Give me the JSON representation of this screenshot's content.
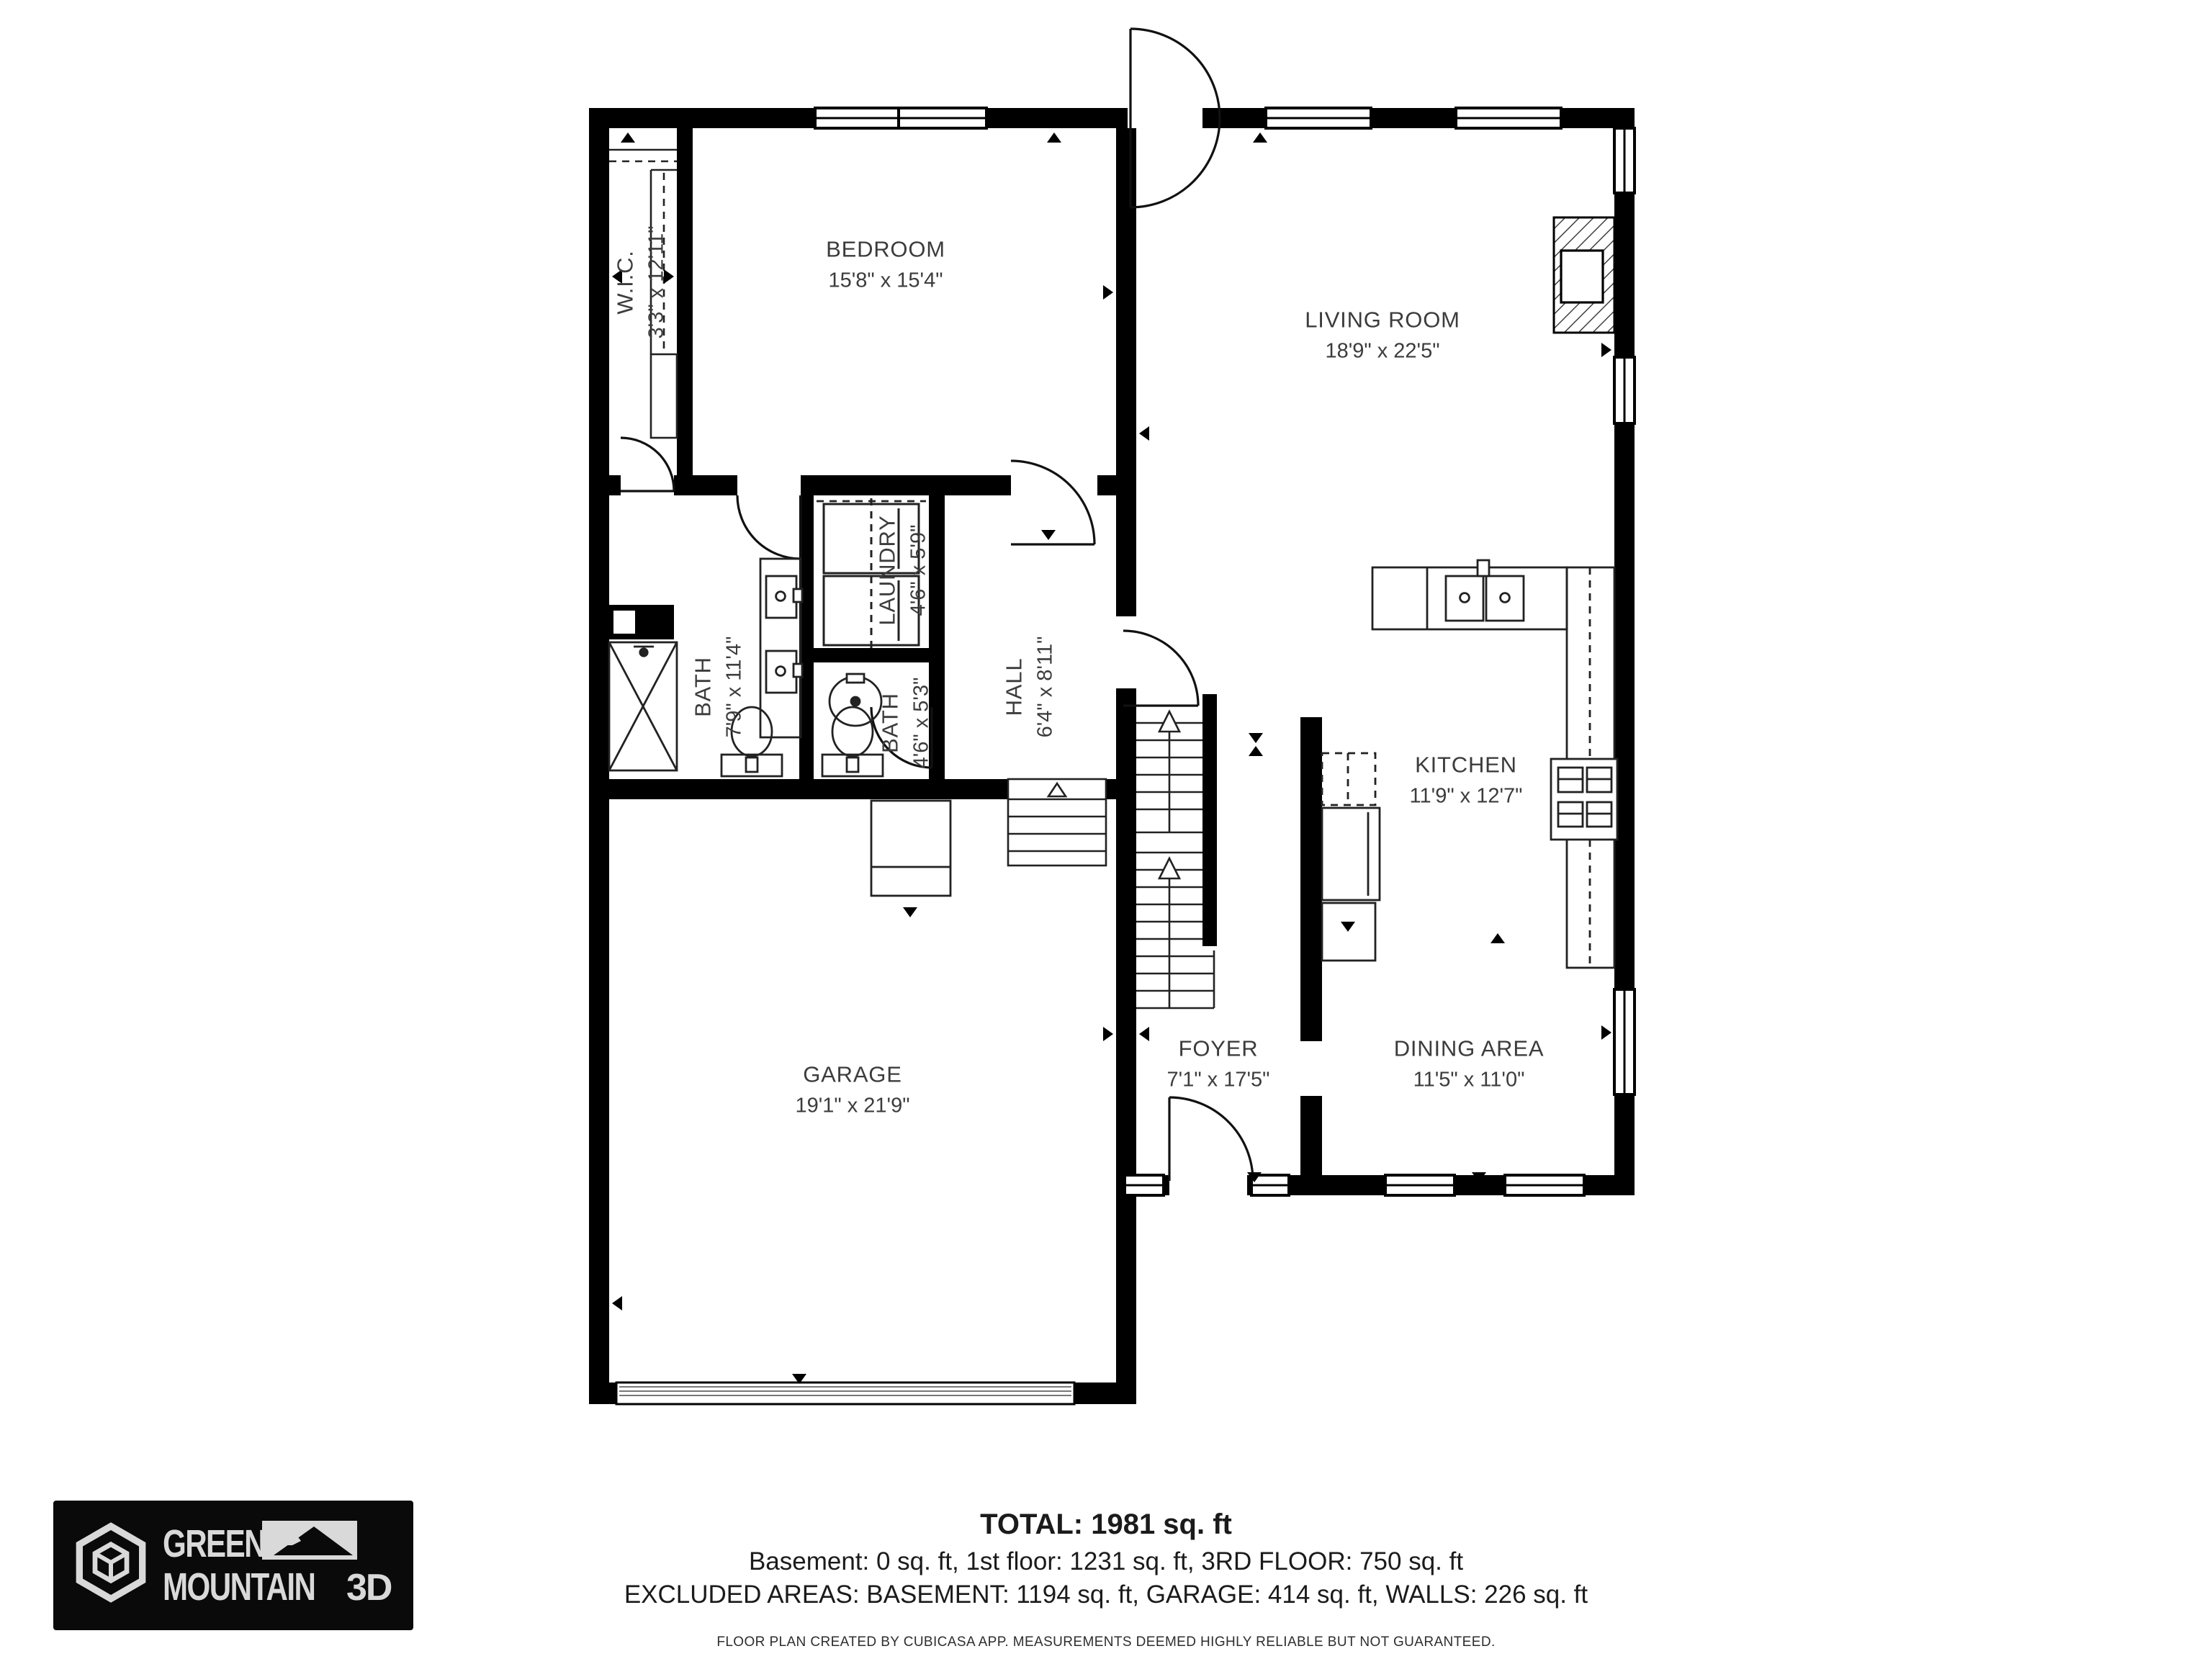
{
  "plan": {
    "rooms": [
      {
        "id": "wic",
        "name": "W.I.C.",
        "dims": "3'3\" x 12'11\""
      },
      {
        "id": "bedroom",
        "name": "BEDROOM",
        "dims": "15'8\" x 15'4\""
      },
      {
        "id": "living_room",
        "name": "LIVING ROOM",
        "dims": "18'9\" x 22'5\""
      },
      {
        "id": "laundry",
        "name": "LAUNDRY",
        "dims": "4'6\" x 5'9\""
      },
      {
        "id": "bath_large",
        "name": "BATH",
        "dims": "7'9\" x 11'4\""
      },
      {
        "id": "bath_small",
        "name": "BATH",
        "dims": "4'6\" x 5'3\""
      },
      {
        "id": "hall",
        "name": "HALL",
        "dims": "6'4\" x 8'11\""
      },
      {
        "id": "kitchen",
        "name": "KITCHEN",
        "dims": "11'9\" x 12'7\""
      },
      {
        "id": "garage",
        "name": "GARAGE",
        "dims": "19'1\" x 21'9\""
      },
      {
        "id": "foyer",
        "name": "FOYER",
        "dims": "7'1\" x 17'5\""
      },
      {
        "id": "dining_area",
        "name": "DINING AREA",
        "dims": "11'5\" x 11'0\""
      }
    ]
  },
  "summary": {
    "total": "TOTAL: 1981 sq. ft",
    "floors": "Basement: 0 sq. ft, 1st floor: 1231 sq. ft, 3RD FLOOR: 750 sq. ft",
    "excluded": "EXCLUDED AREAS: BASEMENT: 1194 sq. ft, GARAGE: 414 sq. ft, WALLS: 226 sq. ft"
  },
  "footer": {
    "disclaimer": "FLOOR PLAN CREATED BY CUBICASA APP. MEASUREMENTS DEEMED HIGHLY RELIABLE BUT NOT GUARANTEED."
  },
  "logo": {
    "line1": "GREEN",
    "line2": "MOUNTAIN",
    "suffix": "3D"
  },
  "colors": {
    "wall": "#000000",
    "text": "#3c3c3c",
    "logo_bg": "#0a0a0a",
    "logo_fg": "#d9d9d9"
  }
}
